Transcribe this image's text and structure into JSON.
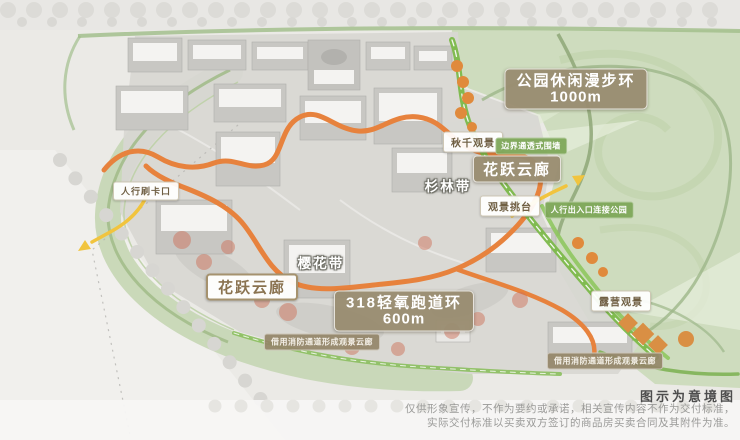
{
  "colors": {
    "track_orange": "#e7823d",
    "fire_lane_green": "#7cb94a",
    "label_brown": "#998c70",
    "label_green": "#7ca656",
    "entrance_yellow": "#f1c43e",
    "park_green": "#cedcbe"
  },
  "labels": {
    "park_loop": {
      "title": "公园休闲漫步环",
      "value": "1000m"
    },
    "swing_view": "秋千观景",
    "boundary_wall": "边界通透式围墙",
    "cloud_corridor_right": "花跃云廊",
    "fir_belt": "杉林带",
    "view_deck": "观景挑台",
    "pedestrian_exit": "人行出入口连接公园",
    "card_gate": "人行刷卡口",
    "cherry_belt": "樱花带",
    "cloud_corridor_left": "花跃云廊",
    "runway_loop": {
      "title": "318轻氧跑道环",
      "value": "600m"
    },
    "fire_lane_left": "借用消防通道形成观景云廊",
    "camping_view": "露营观景",
    "fire_lane_right": "借用消防通道形成观景云廊"
  },
  "footer": {
    "caption": "图示为意境图",
    "disclaimer_line1": "仅供形象宣传，不作为要约或承诺，相关宣传内容不作为交付标准，",
    "disclaimer_line2": "实际交付标准以买卖双方签订的商品房买卖合同及其附件为准。"
  }
}
